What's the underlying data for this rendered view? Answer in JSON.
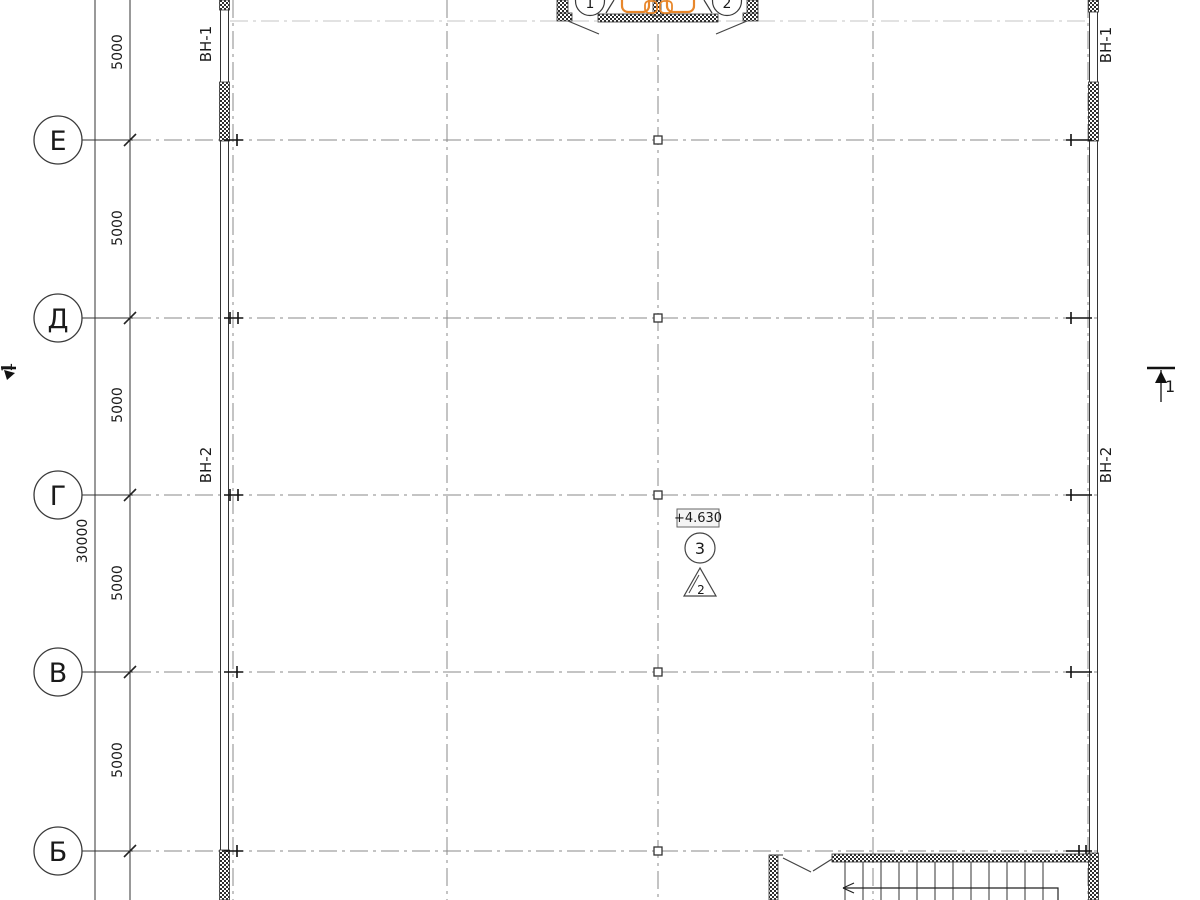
{
  "drawing": {
    "grid_rows": [
      {
        "label": "Е"
      },
      {
        "label": "Д"
      },
      {
        "label": "Г"
      },
      {
        "label": "В"
      },
      {
        "label": "Б"
      }
    ],
    "top_axes": [
      {
        "label": "1"
      },
      {
        "label": "2"
      }
    ],
    "dimensions": {
      "segment_labels": [
        "5000",
        "5000",
        "5000",
        "5000",
        "5000"
      ],
      "total_label": "30000"
    },
    "window_tags": {
      "left_top": "ВН-1",
      "left_mid": "ВН-2",
      "right_top": "ВН-1",
      "right_mid": "ВН-2"
    },
    "annotations": {
      "elevation": "+4.630",
      "detail_circle": "3",
      "detail_triangle": "2",
      "section_left": "1",
      "section_right": "1"
    },
    "colors": {
      "fixture_orange": "#E8872B",
      "line_dark": "#333333",
      "grid_gray": "#8a8a8a"
    }
  }
}
